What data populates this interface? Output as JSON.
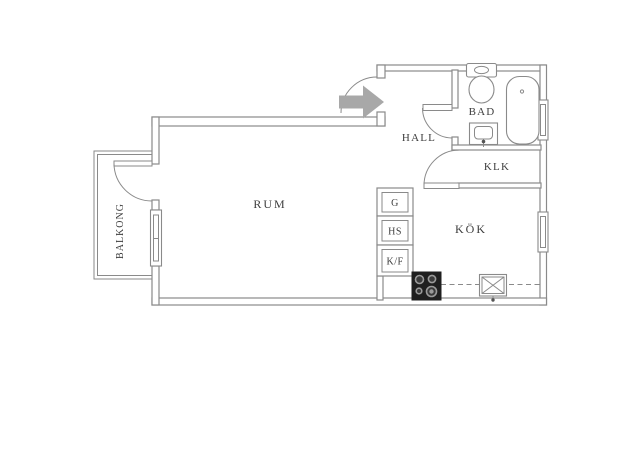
{
  "title": "Apartment floor plan",
  "colors": {
    "bg": "#ffffff",
    "wall": "#8a8a8a",
    "text": "#3d3d3d",
    "arrow": "#a8a8a8",
    "stove": "#1f1f1f"
  },
  "rooms": {
    "rum": {
      "label": "RUM"
    },
    "kok": {
      "label": "KÖK"
    },
    "hall": {
      "label": "HALL"
    },
    "bad": {
      "label": "BAD"
    },
    "klk": {
      "label": "KLK"
    },
    "balkong": {
      "label": "BALKONG"
    }
  },
  "closets": {
    "g": {
      "label": "G"
    },
    "hs": {
      "label": "HS"
    },
    "kf": {
      "label": "K/F"
    }
  },
  "entry": {
    "icon": "entry-arrow-icon",
    "direction": "right"
  },
  "fixtures": {
    "bathroom": [
      "toilet",
      "washbasin",
      "bathtub",
      "window"
    ],
    "kitchen": [
      "stove",
      "sink",
      "counter-dashed-line",
      "window"
    ],
    "rum": [
      "window"
    ],
    "balcony": [
      "balcony-door"
    ]
  },
  "door_arcs": 4,
  "window_symbols": 3
}
